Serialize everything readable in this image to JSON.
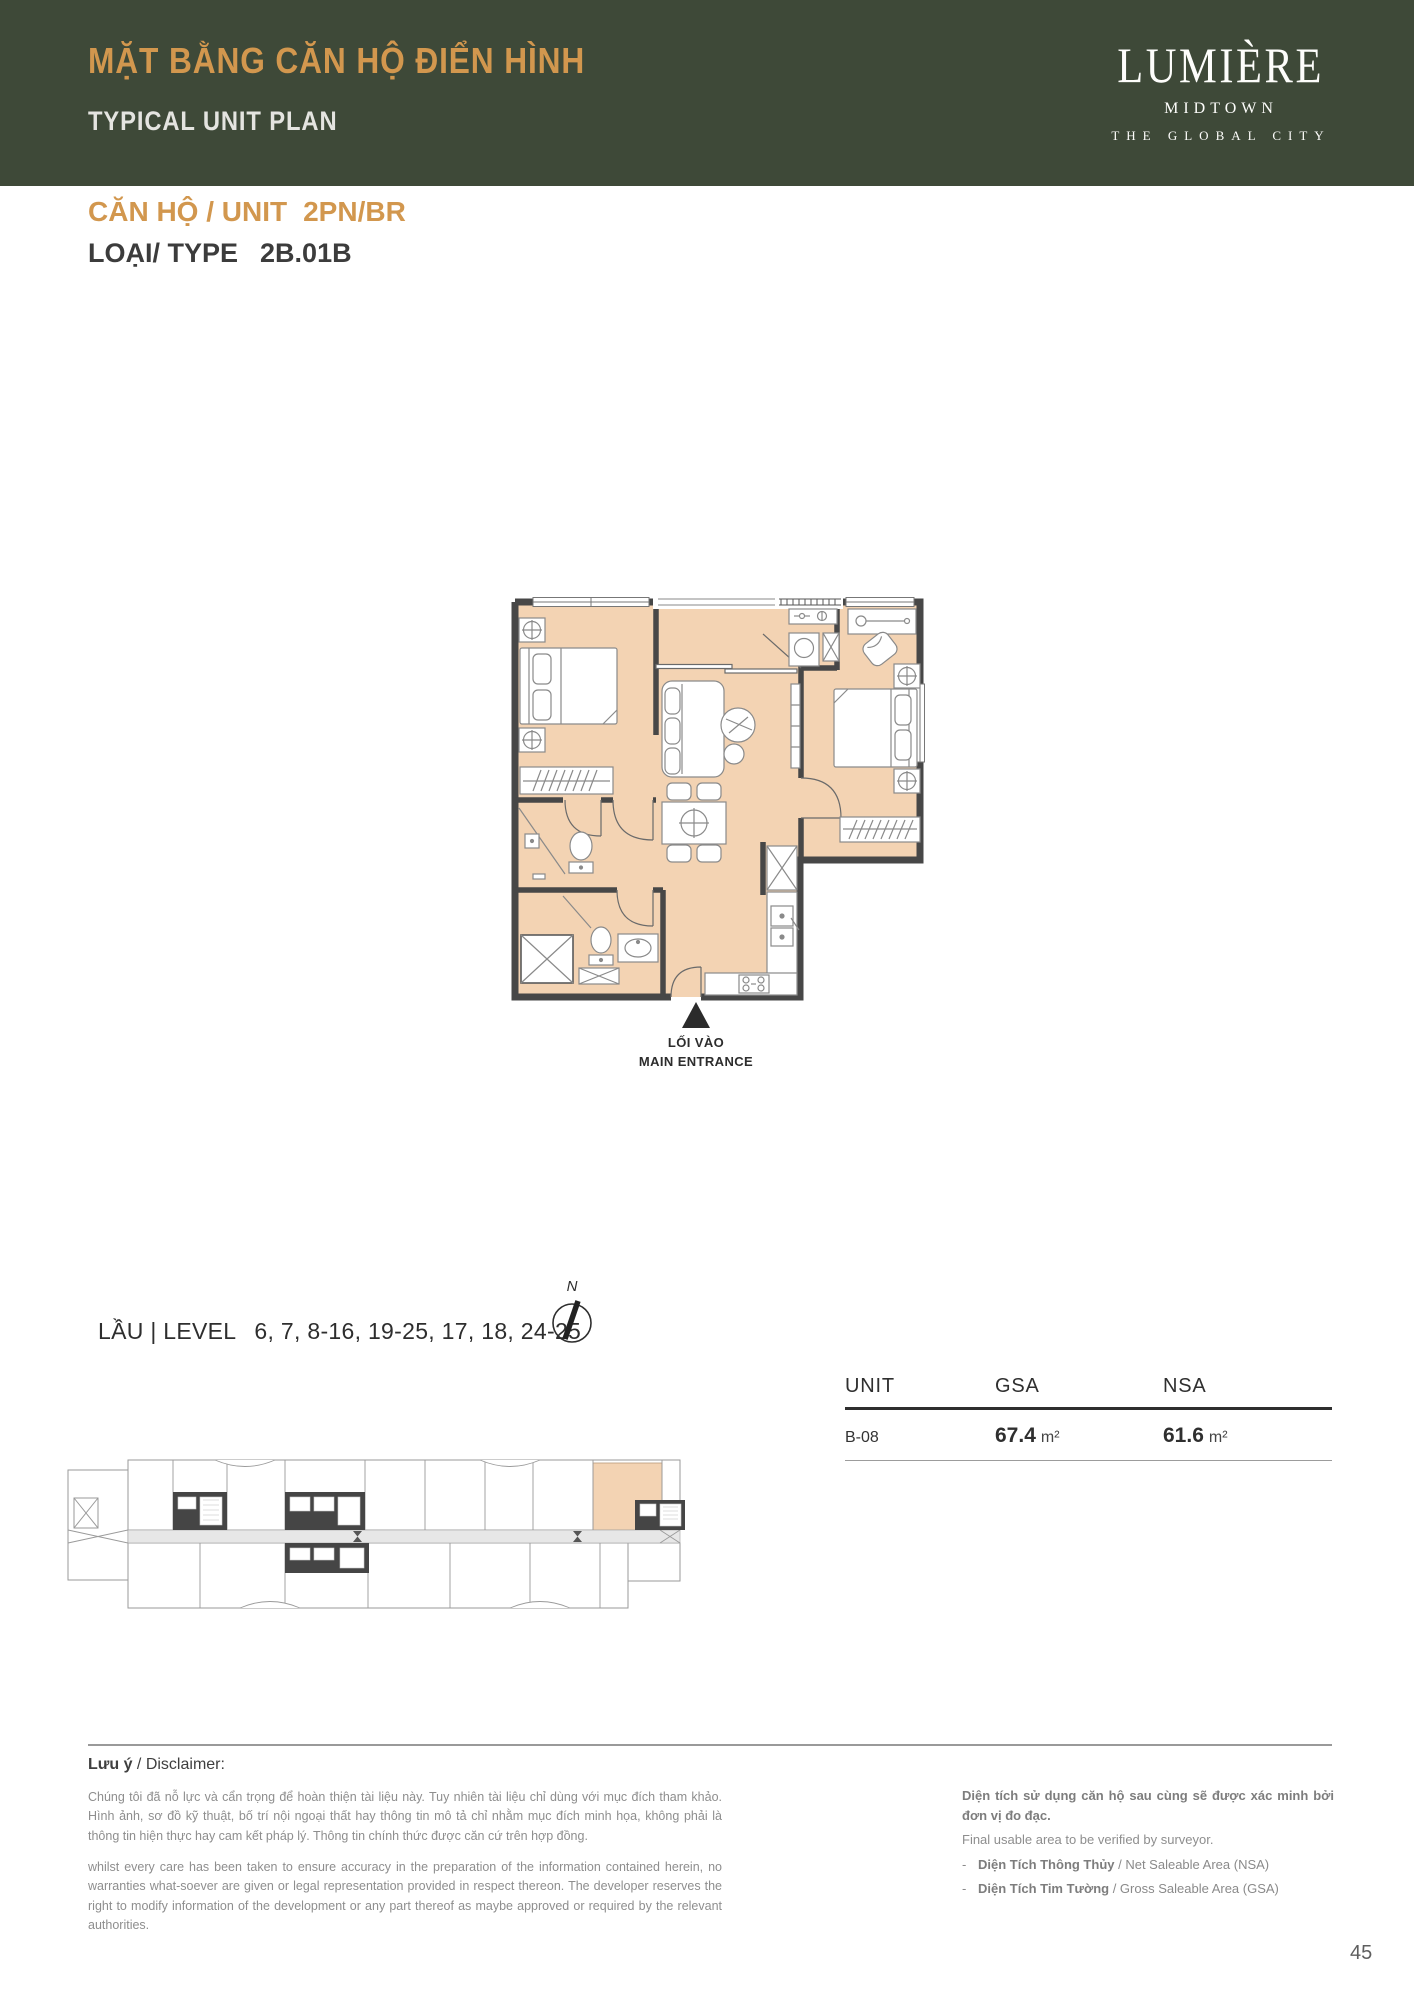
{
  "page": {
    "number": "45",
    "background": "#ffffff"
  },
  "header": {
    "bar_color": "#3E4938",
    "title_vi": "MẶT BẰNG CĂN HỘ ĐIỂN HÌNH",
    "title_vi_color": "#D2974E",
    "title_en": "TYPICAL UNIT PLAN",
    "title_en_color": "#E4E4E0",
    "logo": {
      "name": "LUMIÈRE",
      "sub": "MIDTOWN",
      "tagline": "THE GLOBAL CITY"
    }
  },
  "unit_info": {
    "unit_label": "CĂN HỘ / UNIT",
    "unit_value": "2PN/BR",
    "type_label": "LOẠI/ TYPE",
    "type_value": "2B.01B",
    "accent_color": "#D2974E"
  },
  "floor_plan": {
    "wall_color": "#474747",
    "floor_color": "#F3D3B3",
    "furniture_line_color": "#8A8A8A",
    "entrance": {
      "label_vi": "LỐI VÀO",
      "label_en": "MAIN ENTRANCE"
    }
  },
  "level_info": {
    "label": "LẦU | LEVEL",
    "values": "6, 7, 8-16, 19-25, 17, 18, 24-25"
  },
  "compass": {
    "label": "N"
  },
  "area_table": {
    "columns": [
      "UNIT",
      "GSA",
      "NSA"
    ],
    "row": {
      "unit": "B-08",
      "gsa_value": "67.4",
      "gsa_unit": "m²",
      "nsa_value": "61.6",
      "nsa_unit": "m²"
    }
  },
  "key_plan": {
    "highlight_color": "#F3D3B3",
    "outline_color": "#9A9A9A",
    "core_color": "#454545",
    "corridor_color": "#E7E7E7"
  },
  "disclaimer": {
    "heading_bold": "Lưu ý",
    "heading_rest": " / Disclaimer:",
    "paragraph_vi": "Chúng tôi đã nỗ lực và cẩn trọng để hoàn thiện tài liệu này. Tuy nhiên tài liệu chỉ dùng với mục đích tham khảo. Hình ảnh, sơ đồ kỹ thuật, bố trí nội ngoại thất hay thông tin mô tả chỉ nhằm mục đích minh họa, không phải là thông tin hiện thực hay cam kết pháp lý. Thông tin chính thức được căn cứ trên hợp đồng.",
    "paragraph_en": "whilst every care has been taken to ensure accuracy in the preparation of the information contained herein, no warranties what-soever are given or legal representation provided in respect thereon. The developer reserves the right to modify information of the development or any part thereof as maybe approved or required by the relevant authorities.",
    "note_vi": "Diện tích sử dụng căn hộ sau cùng sẽ được xác minh bởi đơn vị đo đạc.",
    "note_en": "Final usable area to be verified by surveyor.",
    "bullet1_bold": "Diện Tích Thông Thủy",
    "bullet1_rest": " / Net Saleable Area (NSA)",
    "bullet2_bold": "Diện Tích Tim Tường",
    "bullet2_rest": " / Gross Saleable Area (GSA)"
  }
}
